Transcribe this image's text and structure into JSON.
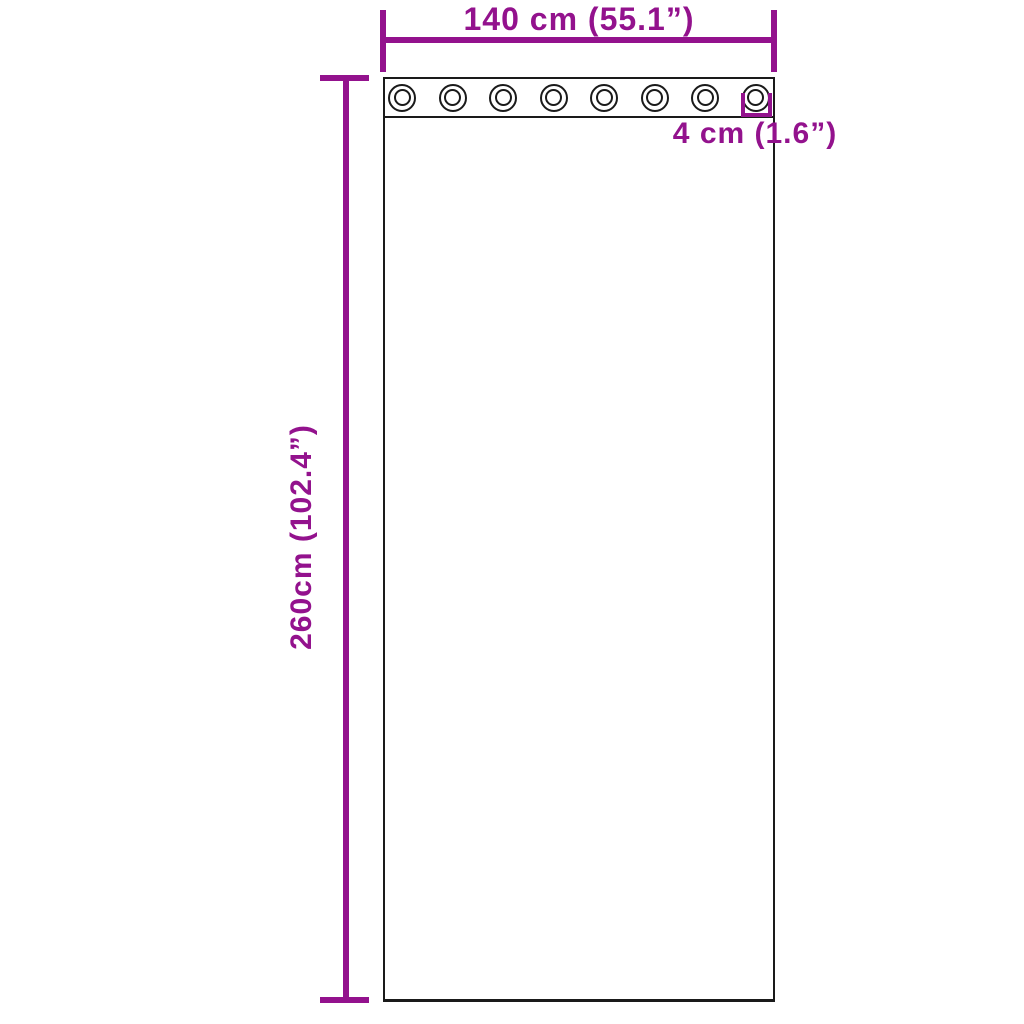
{
  "diagram_type": "product-dimension-diagram",
  "subject": "curtain panel with grommets",
  "labels": {
    "width": "140 cm (55.1”)",
    "height": "260cm (102.4”)",
    "grommet_size": "4 cm (1.6”)"
  },
  "grommets": {
    "count": 8
  },
  "colors": {
    "dimension_line": "#93128d",
    "outline": "#1a1a1a",
    "background": "#ffffff"
  }
}
